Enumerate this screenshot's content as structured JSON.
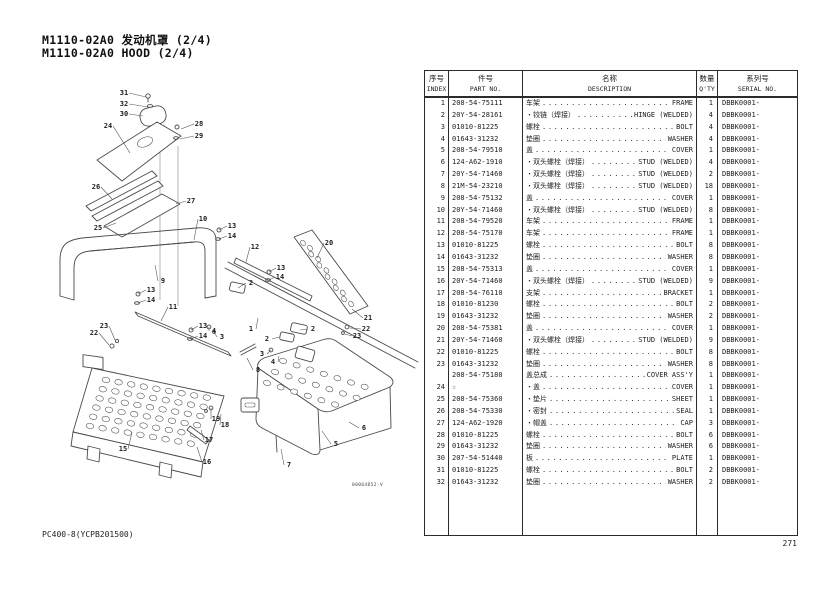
{
  "page": {
    "title_line1": "M1110-02A0 发动机罩 (2/4)",
    "title_line2": "M1110-02A0 HOOD (2/4)",
    "footer_left": "PC400-8(YCPB201500)",
    "page_number": "271",
    "figure_code": "00064852-V"
  },
  "table": {
    "headers": {
      "index_cn": "序号",
      "index_en": "INDEX",
      "part_cn": "件号",
      "part_en": "PART NO.",
      "desc_cn": "名称",
      "desc_en": "DESCRIPTION",
      "qty_cn": "数量",
      "qty_en": "Q'TY",
      "serial_cn": "系列号",
      "serial_en": "SERIAL NO."
    },
    "rows": [
      {
        "index": "1",
        "part": "208-54-75111",
        "name_cn": "车架",
        "name_en": "FRAME",
        "qty": "1",
        "serial": "DBBK0001-"
      },
      {
        "index": "2",
        "part": "20Y-54-28161",
        "name_cn": "・铰链（焊接）",
        "name_en": "HINGE (WELDED)",
        "qty": "4",
        "serial": "DBBK0001-"
      },
      {
        "index": "3",
        "part": "01010-81225",
        "name_cn": "螺栓",
        "name_en": "BOLT",
        "qty": "4",
        "serial": "DBBK0001-"
      },
      {
        "index": "4",
        "part": "01643-31232",
        "name_cn": "垫圈",
        "name_en": "WASHER",
        "qty": "4",
        "serial": "DBBK0001-"
      },
      {
        "index": "5",
        "part": "208-54-79510",
        "name_cn": "盖",
        "name_en": "COVER",
        "qty": "1",
        "serial": "DBBK0001-"
      },
      {
        "index": "6",
        "part": "124-A62-1910",
        "name_cn": "・双头螺栓（焊接）",
        "name_en": "STUD (WELDED)",
        "qty": "4",
        "serial": "DBBK0001-"
      },
      {
        "index": "7",
        "part": "20Y-54-71460",
        "name_cn": "・双头螺栓（焊接）",
        "name_en": "STUD (WELDED)",
        "qty": "2",
        "serial": "DBBK0001-"
      },
      {
        "index": "8",
        "part": "21M-54-23210",
        "name_cn": "・双头螺栓（焊接）",
        "name_en": "STUD (WELDED)",
        "qty": "18",
        "serial": "DBBK0001-"
      },
      {
        "index": "9",
        "part": "208-54-75132",
        "name_cn": "盖",
        "name_en": "COVER",
        "qty": "1",
        "serial": "DBBK0001-"
      },
      {
        "index": "10",
        "part": "20Y-54-71460",
        "name_cn": "・双头螺栓（焊接）",
        "name_en": "STUD (WELDED)",
        "qty": "8",
        "serial": "DBBK0001-"
      },
      {
        "index": "11",
        "part": "208-54-79520",
        "name_cn": "车架",
        "name_en": "FRAME",
        "qty": "1",
        "serial": "DBBK0001-"
      },
      {
        "index": "12",
        "part": "208-54-75170",
        "name_cn": "车架",
        "name_en": "FRAME",
        "qty": "1",
        "serial": "DBBK0001-"
      },
      {
        "index": "13",
        "part": "01010-81225",
        "name_cn": "螺栓",
        "name_en": "BOLT",
        "qty": "8",
        "serial": "DBBK0001-"
      },
      {
        "index": "14",
        "part": "01643-31232",
        "name_cn": "垫圈",
        "name_en": "WASHER",
        "qty": "8",
        "serial": "DBBK0001-"
      },
      {
        "index": "15",
        "part": "208-54-75313",
        "name_cn": "盖",
        "name_en": "COVER",
        "qty": "1",
        "serial": "DBBK0001-"
      },
      {
        "index": "16",
        "part": "20Y-54-71460",
        "name_cn": "・双头螺栓（焊接）",
        "name_en": "STUD (WELDED)",
        "qty": "9",
        "serial": "DBBK0001-"
      },
      {
        "index": "17",
        "part": "208-54-76110",
        "name_cn": "支架",
        "name_en": "BRACKET",
        "qty": "1",
        "serial": "DBBK0001-"
      },
      {
        "index": "18",
        "part": "01010-81230",
        "name_cn": "螺栓",
        "name_en": "BOLT",
        "qty": "2",
        "serial": "DBBK0001-"
      },
      {
        "index": "19",
        "part": "01643-31232",
        "name_cn": "垫圈",
        "name_en": "WASHER",
        "qty": "2",
        "serial": "DBBK0001-"
      },
      {
        "index": "20",
        "part": "208-54-75381",
        "name_cn": "盖",
        "name_en": "COVER",
        "qty": "1",
        "serial": "DBBK0001-"
      },
      {
        "index": "21",
        "part": "20Y-54-71460",
        "name_cn": "・双头螺栓（焊接）",
        "name_en": "STUD (WELDED)",
        "qty": "9",
        "serial": "DBBK0001-"
      },
      {
        "index": "22",
        "part": "01010-81225",
        "name_cn": "螺栓",
        "name_en": "BOLT",
        "qty": "8",
        "serial": "DBBK0001-"
      },
      {
        "index": "23",
        "part": "01643-31232",
        "name_cn": "垫圈",
        "name_en": "WASHER",
        "qty": "8",
        "serial": "DBBK0001-"
      },
      {
        "index": "",
        "part": "208-54-75180",
        "name_cn": "盖总成",
        "name_en": "COVER ASS'Y",
        "qty": "1",
        "serial": "DBBK0001-"
      },
      {
        "index": "24",
        "part": "☆",
        "name_cn": "・盖",
        "name_en": "COVER",
        "qty": "1",
        "serial": "DBBK0001-"
      },
      {
        "index": "25",
        "part": "208-54-75360",
        "name_cn": "・垫片",
        "name_en": "SHEET",
        "qty": "1",
        "serial": "DBBK0001-"
      },
      {
        "index": "26",
        "part": "208-54-75330",
        "name_cn": "・密封",
        "name_en": "SEAL",
        "qty": "1",
        "serial": "DBBK0001-"
      },
      {
        "index": "27",
        "part": "124-A62-1920",
        "name_cn": "・帽盖",
        "name_en": "CAP",
        "qty": "3",
        "serial": "DBBK0001-"
      },
      {
        "index": "28",
        "part": "01010-81225",
        "name_cn": "螺栓",
        "name_en": "BOLT",
        "qty": "6",
        "serial": "DBBK0001-"
      },
      {
        "index": "29",
        "part": "01643-31232",
        "name_cn": "垫圈",
        "name_en": "WASHER",
        "qty": "6",
        "serial": "DBBK0001-"
      },
      {
        "index": "30",
        "part": "207-54-51440",
        "name_cn": "板",
        "name_en": "PLATE",
        "qty": "1",
        "serial": "DBBK0001-"
      },
      {
        "index": "31",
        "part": "01010-81225",
        "name_cn": "螺栓",
        "name_en": "BOLT",
        "qty": "2",
        "serial": "DBBK0001-"
      },
      {
        "index": "32",
        "part": "01643-31232",
        "name_cn": "垫圈",
        "name_en": "WASHER",
        "qty": "2",
        "serial": "DBBK0001-"
      }
    ]
  },
  "diagram": {
    "callouts": [
      {
        "t": "31",
        "x": 124,
        "y": 95,
        "lx": 146,
        "ly": 97
      },
      {
        "t": "32",
        "x": 124,
        "y": 106,
        "lx": 148,
        "ly": 107
      },
      {
        "t": "30",
        "x": 124,
        "y": 116,
        "lx": 143,
        "ly": 116
      },
      {
        "t": "24",
        "x": 108,
        "y": 128,
        "lx": 130,
        "ly": 153
      },
      {
        "t": "28",
        "x": 199,
        "y": 126,
        "lx": 181,
        "ly": 129
      },
      {
        "t": "29",
        "x": 199,
        "y": 138,
        "lx": 180,
        "ly": 139
      },
      {
        "t": "26",
        "x": 96,
        "y": 189,
        "lx": 112,
        "ly": 199
      },
      {
        "t": "27",
        "x": 191,
        "y": 203,
        "lx": 176,
        "ly": 204
      },
      {
        "t": "25",
        "x": 98,
        "y": 230,
        "lx": 116,
        "ly": 223
      },
      {
        "t": "10",
        "x": 203,
        "y": 221,
        "lx": 194,
        "ly": 240
      },
      {
        "t": "13",
        "x": 232,
        "y": 228,
        "lx": 219,
        "ly": 230
      },
      {
        "t": "14",
        "x": 232,
        "y": 238,
        "lx": 219,
        "ly": 239
      },
      {
        "t": "12",
        "x": 255,
        "y": 249,
        "lx": 246,
        "ly": 262
      },
      {
        "t": "13",
        "x": 281,
        "y": 270,
        "lx": 269,
        "ly": 272
      },
      {
        "t": "14",
        "x": 280,
        "y": 279,
        "lx": 269,
        "ly": 280
      },
      {
        "t": "2",
        "x": 251,
        "y": 285,
        "lx": 238,
        "ly": 288
      },
      {
        "t": "9",
        "x": 163,
        "y": 283,
        "lx": 155,
        "ly": 265
      },
      {
        "t": "13",
        "x": 151,
        "y": 292,
        "lx": 138,
        "ly": 294
      },
      {
        "t": "14",
        "x": 151,
        "y": 302,
        "lx": 138,
        "ly": 303
      },
      {
        "t": "11",
        "x": 173,
        "y": 309,
        "lx": 161,
        "ly": 321
      },
      {
        "t": "13",
        "x": 203,
        "y": 328,
        "lx": 191,
        "ly": 330
      },
      {
        "t": "14",
        "x": 203,
        "y": 338,
        "lx": 191,
        "ly": 339
      },
      {
        "t": "20",
        "x": 329,
        "y": 245,
        "lx": 317,
        "ly": 258
      },
      {
        "t": "21",
        "x": 368,
        "y": 320,
        "lx": 352,
        "ly": 309
      },
      {
        "t": "22",
        "x": 366,
        "y": 331,
        "lx": 350,
        "ly": 328
      },
      {
        "t": "23",
        "x": 357,
        "y": 338,
        "lx": 345,
        "ly": 334
      },
      {
        "t": "2",
        "x": 313,
        "y": 331,
        "lx": 300,
        "ly": 330
      },
      {
        "t": "2",
        "x": 267,
        "y": 341,
        "lx": 279,
        "ly": 337
      },
      {
        "t": "3",
        "x": 262,
        "y": 356,
        "lx": 271,
        "ly": 350
      },
      {
        "t": "4",
        "x": 273,
        "y": 364,
        "lx": 279,
        "ly": 356
      },
      {
        "t": "4",
        "x": 214,
        "y": 333,
        "lx": 209,
        "ly": 327
      },
      {
        "t": "3",
        "x": 222,
        "y": 339,
        "lx": 214,
        "ly": 332
      },
      {
        "t": "23",
        "x": 104,
        "y": 328,
        "lx": 115,
        "ly": 340
      },
      {
        "t": "22",
        "x": 94,
        "y": 335,
        "lx": 109,
        "ly": 345
      },
      {
        "t": "1",
        "x": 251,
        "y": 331,
        "lx": 258,
        "ly": 318
      },
      {
        "t": "8",
        "x": 258,
        "y": 372,
        "lx": 247,
        "ly": 358
      },
      {
        "t": "19",
        "x": 216,
        "y": 421,
        "lx": 211,
        "ly": 408
      },
      {
        "t": "18",
        "x": 225,
        "y": 427,
        "lx": 221,
        "ly": 414
      },
      {
        "t": "17",
        "x": 209,
        "y": 442,
        "lx": 201,
        "ly": 430
      },
      {
        "t": "15",
        "x": 123,
        "y": 451,
        "lx": 132,
        "ly": 432
      },
      {
        "t": "16",
        "x": 207,
        "y": 464,
        "lx": 197,
        "ly": 447
      },
      {
        "t": "6",
        "x": 364,
        "y": 430,
        "lx": 349,
        "ly": 422
      },
      {
        "t": "5",
        "x": 336,
        "y": 446,
        "lx": 322,
        "ly": 431
      },
      {
        "t": "7",
        "x": 289,
        "y": 467,
        "lx": 281,
        "ly": 449
      }
    ]
  }
}
